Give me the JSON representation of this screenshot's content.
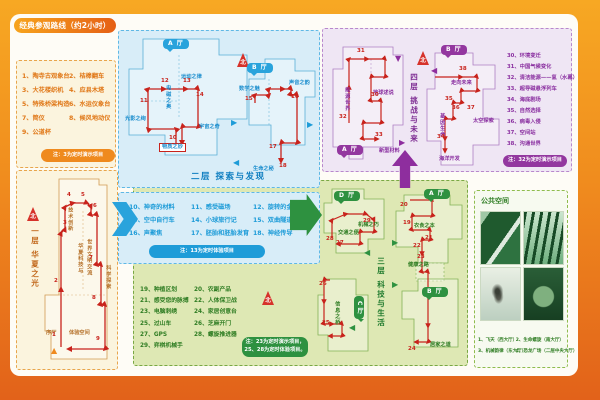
{
  "title": "经典参观路线（约2小时）",
  "colors": {
    "accent_orange": "#EF8A1E",
    "floor2_blue": "#1E9CD8",
    "floor3_green": "#2E9140",
    "floor4_purple": "#93379F",
    "route_red": "#C8231C"
  },
  "floor1": {
    "name": "一层 华夏之光",
    "items": [
      "1、陶寺古观象台",
      "2、桔槔翻车",
      "3、大花楼织机",
      "4、应县木塔",
      "5、特殊桥梁构造",
      "6、水运仪象台",
      "7、简仪",
      "8、候风地动仪",
      "9、公道杯"
    ],
    "note": "注：3为定时演示项目",
    "marks": [
      {
        "t": "北",
        "c": "compass",
        "x": 10,
        "y": 36
      },
      {
        "t": "一层 华夏之光",
        "c": "ft v",
        "x": 14,
        "y": 56
      },
      {
        "t": "技术创新",
        "c": "z v",
        "x": 50,
        "y": 36
      },
      {
        "t": "华夏科技与",
        "c": "z v",
        "x": 60,
        "y": 72
      },
      {
        "t": "世界文明交流",
        "c": "z v",
        "x": 69,
        "y": 68
      },
      {
        "t": "科学探索",
        "c": "z v",
        "x": 88,
        "y": 94
      },
      {
        "t": "序厅",
        "c": "z",
        "x": 29,
        "y": 160
      },
      {
        "t": "体验空间",
        "c": "z",
        "x": 52,
        "y": 160
      },
      {
        "t": "▲",
        "c": "tri tri-o",
        "x": 34,
        "y": 176
      },
      {
        "t": "1",
        "c": "num",
        "x": 35,
        "y": 162
      },
      {
        "t": "2",
        "c": "num",
        "x": 37,
        "y": 108
      },
      {
        "t": "3",
        "c": "num",
        "x": 46,
        "y": 50
      },
      {
        "t": "4",
        "c": "num",
        "x": 50,
        "y": 22
      },
      {
        "t": "5",
        "c": "num",
        "x": 64,
        "y": 22
      },
      {
        "t": "6",
        "c": "num",
        "x": 76,
        "y": 33
      },
      {
        "t": "7",
        "c": "num",
        "x": 72,
        "y": 85
      },
      {
        "t": "8",
        "c": "num",
        "x": 75,
        "y": 125
      },
      {
        "t": "9",
        "c": "num",
        "x": 79,
        "y": 166
      }
    ]
  },
  "floor2": {
    "name": "二层 探索与发现",
    "items": [
      "10、神奇的材料",
      "11、感受磁场",
      "12、旋转的金蛋",
      "13、空中自行车",
      "14、小球旅行记",
      "15、双曲隧道",
      "16、声聚焦",
      "17、胚胎和胚胎发育",
      "18、神经传导"
    ],
    "note": "注：13为定时体验项目",
    "marks": [
      {
        "t": "北",
        "c": "compass",
        "x": 118,
        "y": 22
      },
      {
        "t": "A 厅",
        "c": "hall",
        "x": 44,
        "y": 8
      },
      {
        "t": "B 厅",
        "c": "hall",
        "x": 128,
        "y": 32
      },
      {
        "t": "运动之律",
        "c": "z",
        "x": 62,
        "y": 44
      },
      {
        "t": "电磁之奥",
        "c": "z v",
        "x": 46,
        "y": 54
      },
      {
        "t": "光影之绚",
        "c": "z",
        "x": 6,
        "y": 86
      },
      {
        "t": "宇宙之奇",
        "c": "z",
        "x": 80,
        "y": 94
      },
      {
        "t": "物质之妙",
        "c": "z box",
        "x": 40,
        "y": 112
      },
      {
        "t": "数学之魅",
        "c": "z",
        "x": 120,
        "y": 56
      },
      {
        "t": "声音之韵",
        "c": "z",
        "x": 170,
        "y": 50
      },
      {
        "t": "生命之秘",
        "c": "z",
        "x": 134,
        "y": 136
      },
      {
        "t": "二层 探索与发现",
        "c": "sec",
        "x": 72,
        "y": 142
      },
      {
        "t": "▶",
        "c": "tri tri-b",
        "x": 112,
        "y": 88
      },
      {
        "t": "◀",
        "c": "tri tri-b",
        "x": 114,
        "y": 128
      },
      {
        "t": "▶",
        "c": "tri tri-b",
        "x": 188,
        "y": 90
      },
      {
        "t": "10",
        "c": "num",
        "x": 50,
        "y": 105
      },
      {
        "t": "11",
        "c": "num",
        "x": 21,
        "y": 68
      },
      {
        "t": "12",
        "c": "num",
        "x": 42,
        "y": 48
      },
      {
        "t": "13",
        "c": "num",
        "x": 64,
        "y": 48
      },
      {
        "t": "14",
        "c": "num",
        "x": 77,
        "y": 62
      },
      {
        "t": "15",
        "c": "num",
        "x": 126,
        "y": 66
      },
      {
        "t": "16",
        "c": "num",
        "x": 172,
        "y": 64
      },
      {
        "t": "17",
        "c": "num",
        "x": 150,
        "y": 114
      },
      {
        "t": "18",
        "c": "num",
        "x": 160,
        "y": 133
      }
    ]
  },
  "floor3": {
    "name": "三层 科技与生活",
    "items": [
      "19、种植区划",
      "20、农副产品",
      "21、感受您的脉搏",
      "22、人体保卫战",
      "23、电脑刺绣",
      "24、家居创意台",
      "25、过山车",
      "26、芝麻开门",
      "27、GPS",
      "28、螺旋推进器",
      "29、弈棋机械手"
    ],
    "note1": "注：23为定时演示项目，",
    "note2": "25、28为定时体验项目。",
    "marks": [
      {
        "t": "北",
        "c": "compass",
        "x": 128,
        "y": 110
      },
      {
        "t": "D 厅",
        "c": "hall",
        "x": 200,
        "y": 10
      },
      {
        "t": "A 厅",
        "c": "hall",
        "x": 290,
        "y": 8
      },
      {
        "t": "C 厅",
        "c": "hall v",
        "x": 220,
        "y": 115
      },
      {
        "t": "B 厅",
        "c": "hall",
        "x": 288,
        "y": 106
      },
      {
        "t": "交通之便",
        "c": "z",
        "x": 204,
        "y": 50
      },
      {
        "t": "机械之巧",
        "c": "z",
        "x": 224,
        "y": 42
      },
      {
        "t": "衣食之本",
        "c": "z",
        "x": 280,
        "y": 43
      },
      {
        "t": "健康之路",
        "c": "z",
        "x": 274,
        "y": 82
      },
      {
        "t": "居家之道",
        "c": "z",
        "x": 296,
        "y": 162
      },
      {
        "t": "信息之桥",
        "c": "z v",
        "x": 200,
        "y": 120
      },
      {
        "t": "三层 科技与生活",
        "c": "ft v",
        "x": 243,
        "y": 76
      },
      {
        "t": "◀",
        "c": "tri tri-g",
        "x": 230,
        "y": 68
      },
      {
        "t": "▶",
        "c": "tri tri-g",
        "x": 258,
        "y": 58
      },
      {
        "t": "▶",
        "c": "tri tri-g",
        "x": 258,
        "y": 100
      },
      {
        "t": "◀",
        "c": "tri tri-g",
        "x": 215,
        "y": 143
      },
      {
        "t": "19",
        "c": "num",
        "x": 269,
        "y": 40
      },
      {
        "t": "20",
        "c": "num",
        "x": 266,
        "y": 22
      },
      {
        "t": "21",
        "c": "num",
        "x": 291,
        "y": 55
      },
      {
        "t": "22",
        "c": "num",
        "x": 279,
        "y": 63
      },
      {
        "t": "23",
        "c": "num",
        "x": 283,
        "y": 74
      },
      {
        "t": "24",
        "c": "num",
        "x": 274,
        "y": 166
      },
      {
        "t": "25",
        "c": "num",
        "x": 188,
        "y": 140
      },
      {
        "t": "26",
        "c": "num",
        "x": 185,
        "y": 101
      },
      {
        "t": "27",
        "c": "num",
        "x": 202,
        "y": 60
      },
      {
        "t": "28",
        "c": "num",
        "x": 192,
        "y": 56
      },
      {
        "t": "29",
        "c": "num",
        "x": 229,
        "y": 38
      }
    ]
  },
  "floor4": {
    "name": "四层 挑战与未来",
    "items": [
      "30、环境变迁",
      "31、中国气候变化",
      "32、清洁能源——氢（水幕）",
      "33、超导磁悬浮列车",
      "34、海底剧场",
      "35、自然选择",
      "36、病毒入侵",
      "37、空间站",
      "38、沟通世界"
    ],
    "note": "注：32为定时演示项目",
    "marks": [
      {
        "t": "北",
        "c": "compass",
        "x": 94,
        "y": 22
      },
      {
        "t": "四层 挑战与未来",
        "c": "ft v",
        "x": 87,
        "y": 44
      },
      {
        "t": "A 厅",
        "c": "hall",
        "x": 14,
        "y": 116
      },
      {
        "t": "B 厅",
        "c": "hall",
        "x": 118,
        "y": 16
      },
      {
        "t": "能源世界",
        "c": "z v",
        "x": 21,
        "y": 58
      },
      {
        "t": "地球述说",
        "c": "z",
        "x": 50,
        "y": 62
      },
      {
        "t": "新型材料",
        "c": "z",
        "x": 56,
        "y": 120
      },
      {
        "t": "走向未来",
        "c": "z",
        "x": 128,
        "y": 52
      },
      {
        "t": "基因生命",
        "c": "z v",
        "x": 116,
        "y": 84
      },
      {
        "t": "太空探索",
        "c": "z",
        "x": 150,
        "y": 90
      },
      {
        "t": "海洋开发",
        "c": "z",
        "x": 116,
        "y": 128
      },
      {
        "t": "▼",
        "c": "tri tri-p",
        "x": 72,
        "y": 26
      },
      {
        "t": "◀",
        "c": "tri tri-p",
        "x": 108,
        "y": 38
      },
      {
        "t": "▶",
        "c": "tri tri-p",
        "x": 76,
        "y": 110
      },
      {
        "t": "30",
        "c": "num",
        "x": 48,
        "y": 64
      },
      {
        "t": "31",
        "c": "num",
        "x": 34,
        "y": 20
      },
      {
        "t": "32",
        "c": "num",
        "x": 16,
        "y": 86
      },
      {
        "t": "33",
        "c": "num",
        "x": 52,
        "y": 104
      },
      {
        "t": "34",
        "c": "num",
        "x": 114,
        "y": 106
      },
      {
        "t": "35",
        "c": "num",
        "x": 122,
        "y": 68
      },
      {
        "t": "36",
        "c": "num",
        "x": 129,
        "y": 77
      },
      {
        "t": "37",
        "c": "num",
        "x": 144,
        "y": 77
      },
      {
        "t": "38",
        "c": "num",
        "x": 136,
        "y": 38
      }
    ]
  },
  "public_space": {
    "title": "公共空间",
    "captions": [
      "1、飞天（西大厅）",
      "2、生命螺旋（南大厅）",
      "3、机械韵律（东大厅）",
      "4、恐龙广场（二层中央大厅）"
    ]
  }
}
